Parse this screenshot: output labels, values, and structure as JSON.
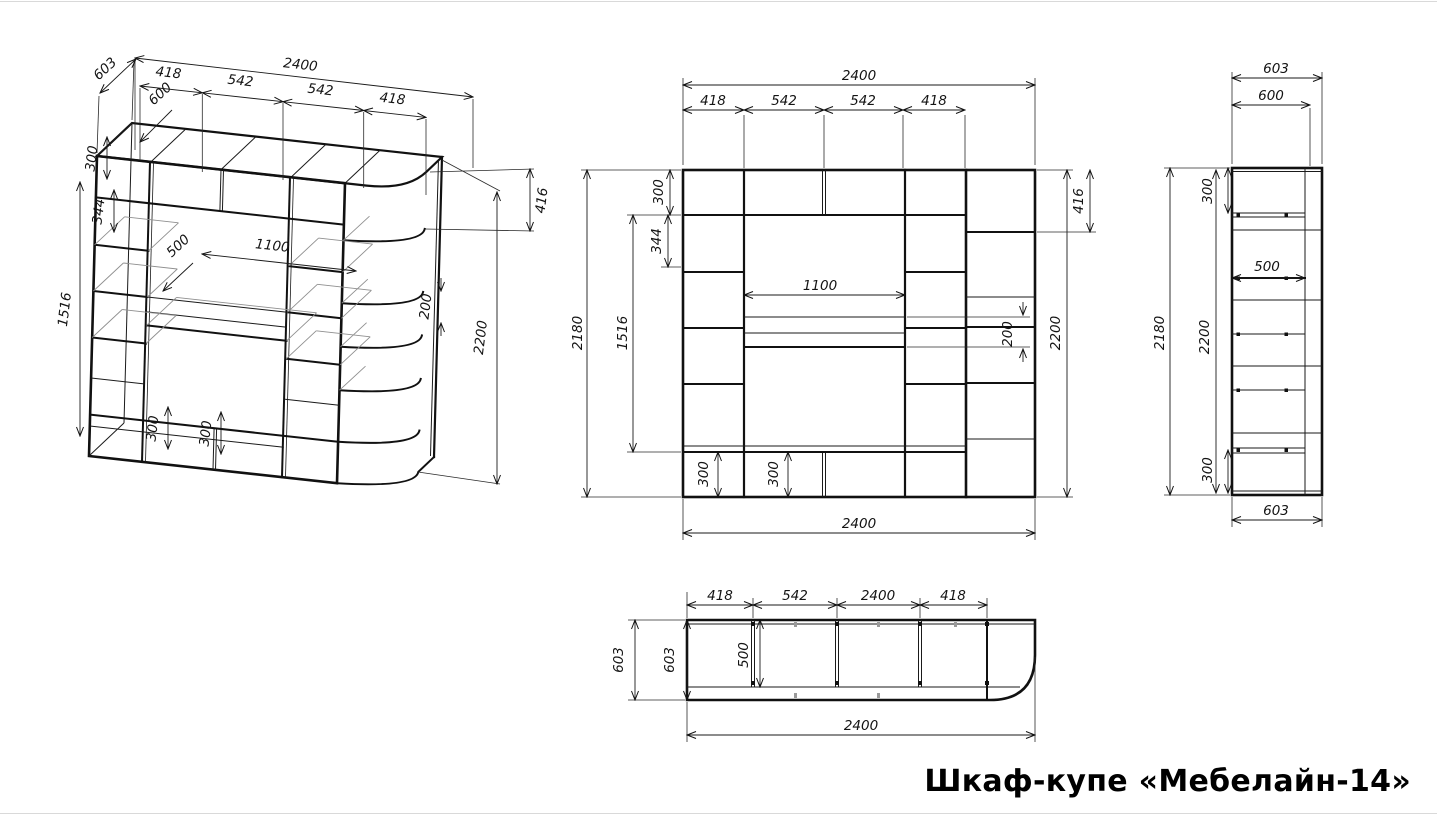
{
  "title": "Шкаф-купе «Мебелайн-14»",
  "iso": {
    "d603": "603",
    "s418a": "418",
    "d600": "600",
    "w2400": "2400",
    "s542a": "542",
    "s542b": "542",
    "s418b": "418",
    "c300": "300",
    "c344": "344",
    "h1516": "1516",
    "n1100": "1100",
    "d500": "500",
    "g200": "200",
    "h2200": "2200",
    "t416": "416",
    "b300a": "300",
    "b300b": "300"
  },
  "front": {
    "w2400top": "2400",
    "s418a": "418",
    "s542a": "542",
    "s542b": "542",
    "s418b": "418",
    "h2180": "2180",
    "h1516": "1516",
    "c300": "300",
    "c344": "344",
    "n1100": "1100",
    "g200": "200",
    "h2200": "2200",
    "t416": "416",
    "b300a": "300",
    "b300b": "300",
    "w2400bot": "2400"
  },
  "side": {
    "d603top": "603",
    "d600": "600",
    "h2180": "2180",
    "c300top": "300",
    "s500": "500",
    "h2200": "2200",
    "c300bot": "300",
    "d603bot": "603"
  },
  "plan": {
    "s418a": "418",
    "s542": "542",
    "s2400": "2400",
    "s418b": "418",
    "d603out": "603",
    "d603in": "603",
    "s500": "500",
    "w2400": "2400"
  }
}
